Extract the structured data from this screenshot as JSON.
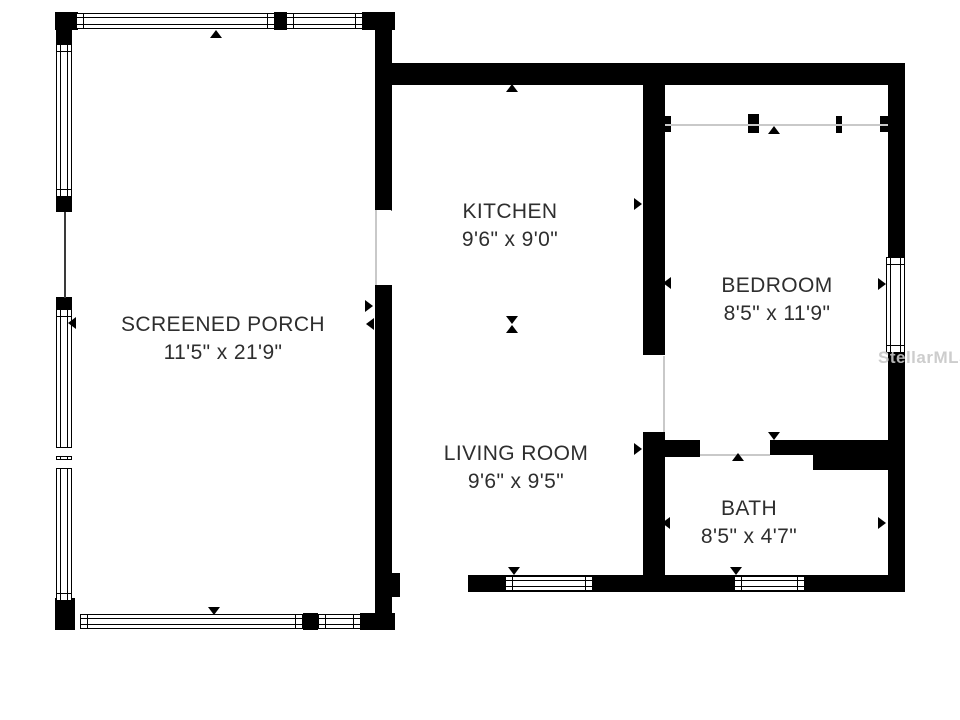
{
  "colors": {
    "wall": "#000000",
    "text": "#2e2e2e",
    "background": "#ffffff",
    "thin_line": "#c9c9c9",
    "watermark": "#c8c8c8"
  },
  "watermark": {
    "text": "StellarMLS"
  },
  "rooms": [
    {
      "id": "screened-porch",
      "name": "SCREENED PORCH",
      "dimensions": "11'5\" x 21'9\""
    },
    {
      "id": "kitchen",
      "name": "KITCHEN",
      "dimensions": "9'6\" x 9'0\""
    },
    {
      "id": "living-room",
      "name": "LIVING ROOM",
      "dimensions": "9'6\" x 9'5\""
    },
    {
      "id": "bedroom",
      "name": "BEDROOM",
      "dimensions": "8'5\" x 11'9\""
    },
    {
      "id": "bath",
      "name": "BATH",
      "dimensions": "8'5\" x 4'7\""
    }
  ]
}
